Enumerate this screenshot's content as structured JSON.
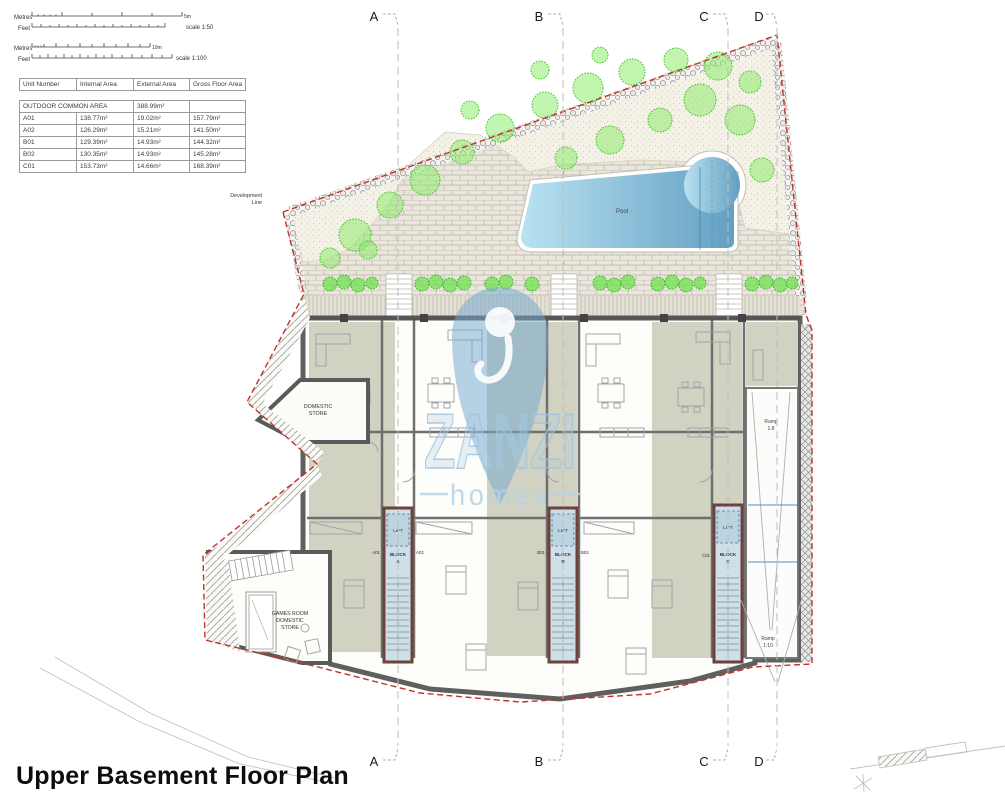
{
  "title": "Upper Basement Floor Plan",
  "scale_bar": {
    "metres": "Metres",
    "feet": "Feet",
    "scale_50": "scale 1:50",
    "scale_100": "scale 1:100",
    "end_5m": "5m",
    "end_10m": "10m"
  },
  "table": {
    "headers": [
      "Unit Number",
      "Internal Area",
      "External Area",
      "Gross Floor Area"
    ],
    "rows": [
      {
        "cells": [
          {
            "text": "OUTDOOR COMMON AREA",
            "span": 2
          },
          {
            "text": "388.99m²"
          },
          {
            "text": ""
          }
        ]
      },
      {
        "cells": [
          {
            "text": "A01"
          },
          {
            "text": "138.77m²"
          },
          {
            "text": "19.02m²"
          },
          {
            "text": "157.79m²"
          }
        ]
      },
      {
        "cells": [
          {
            "text": "A02"
          },
          {
            "text": "126.29m²"
          },
          {
            "text": "15.21m²"
          },
          {
            "text": "141.50m²"
          }
        ]
      },
      {
        "cells": [
          {
            "text": "B01"
          },
          {
            "text": "129.39m²"
          },
          {
            "text": "14.93m²"
          },
          {
            "text": "144.32m²"
          }
        ]
      },
      {
        "cells": [
          {
            "text": "B02"
          },
          {
            "text": "130.35m²"
          },
          {
            "text": "14.93m²"
          },
          {
            "text": "145.28m²"
          }
        ]
      },
      {
        "cells": [
          {
            "text": "C01"
          },
          {
            "text": "153.73m²"
          },
          {
            "text": "14.66m²"
          },
          {
            "text": "168.39m²"
          }
        ]
      }
    ]
  },
  "grid": {
    "a": "A",
    "b": "B",
    "c": "C",
    "d": "D"
  },
  "labels": {
    "pool": "Pool",
    "lift": "LIFT",
    "block_word": "BLOCK",
    "development_1": "Development",
    "development_2": "Line",
    "domestic_1": "DOMESTIC",
    "domestic_2": "STORE",
    "games_1": "GAMES ROOM",
    "games_2": "DOMESTIC",
    "games_3": "STORE",
    "ramp_upper_1": "Ramp",
    "ramp_upper_2": "1:8",
    "ramp_lower_1": "Ramp",
    "ramp_lower_2": "1:10"
  },
  "cores": {
    "a": "A",
    "b": "B",
    "c": "C"
  },
  "unit_tags": {
    "a01": "A01",
    "a02": "A02",
    "b01": "B01",
    "b02": "B02",
    "c01": "C01"
  },
  "watermark": {
    "name": "ZANZI",
    "tagline": "homes"
  },
  "colors": {
    "boundary_red": "#c23327",
    "wall_grey": "#5f5f5f",
    "sage": "#d2d2c2",
    "core_blue": "#cfdfe8",
    "pool_light": "#aedcef",
    "pool_dark": "#639fc2",
    "foliage_green": "#6fe24f",
    "watermark_blue": "#74a9cf"
  }
}
